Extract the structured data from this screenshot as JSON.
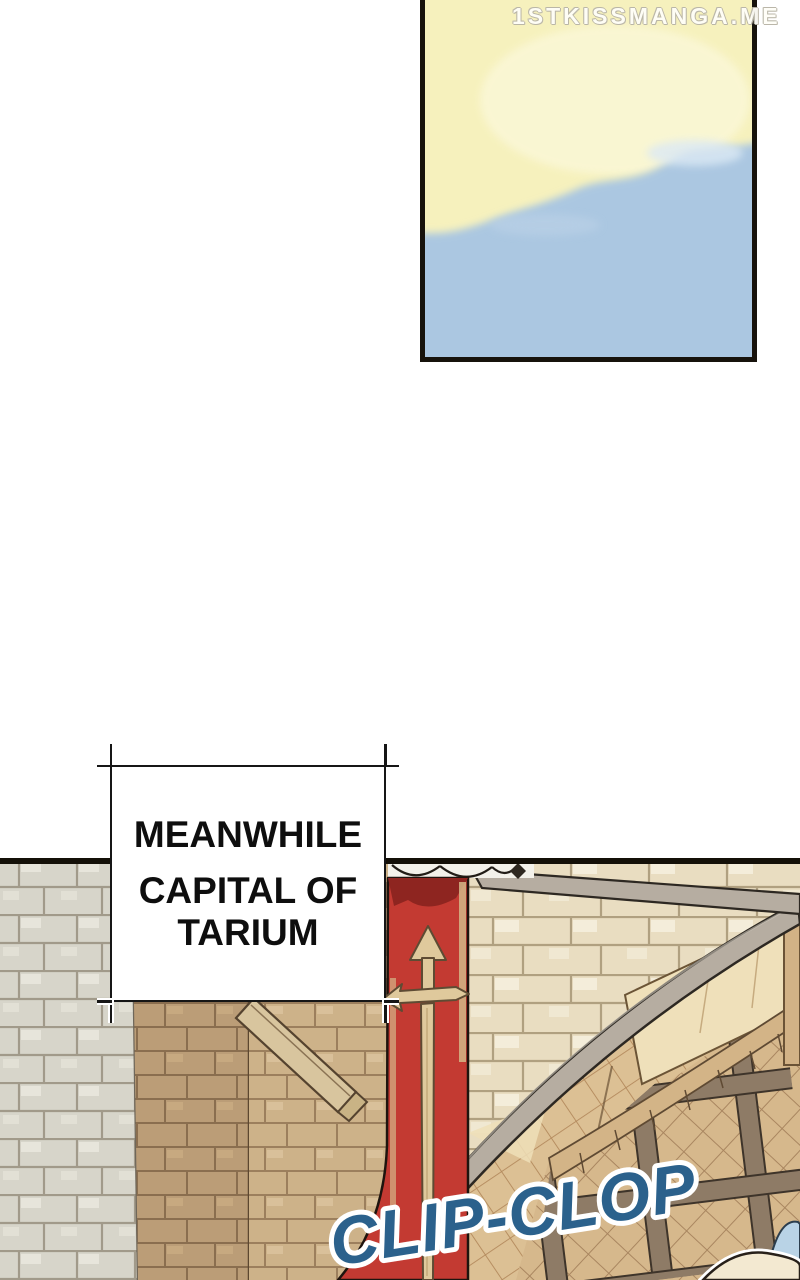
{
  "watermark": {
    "text": "1STKISSMANGA.ME"
  },
  "caption_box": {
    "line1": "MEANWHILE",
    "line2": "CAPITAL OF",
    "line3": "TARIUM"
  },
  "sfx": {
    "text": "CLIP-CLOP"
  },
  "panels": {
    "sky_panel": "sky with yellow glow and blue clouds",
    "gate_panel": "stone gate of the capital of Tarium with sword banner and lattice portcullis"
  },
  "colors": {
    "sky_yellow": "#f6f1bd",
    "sky_blue": "#abc7e1",
    "panel_border": "#17130c",
    "banner_red": "#c33a32",
    "banner_fold_red": "#8e2520",
    "sword_tan": "#dfc99c",
    "sfx_fill": "#2b618c",
    "sfx_outline": "#ffffff",
    "gray_stone": "#d7d5ca",
    "tan_stone_shadow": "#bb9d77",
    "tan_stone_light": "#cdb289",
    "cream_stone": "#e9ddc1",
    "arch_gray": "#b6ada1",
    "lattice_brown": "#8e7b66",
    "caption_text": "#0e0e0e"
  }
}
